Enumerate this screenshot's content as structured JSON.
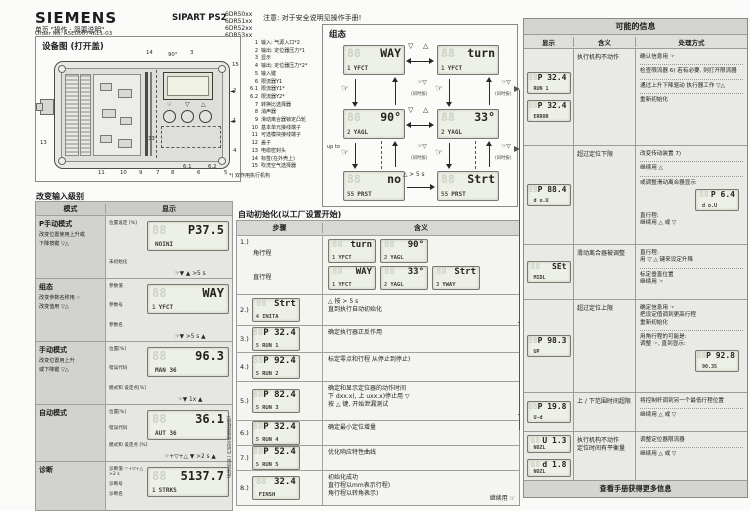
{
  "decor": {
    "lcd_ghost": "88"
  },
  "header": {
    "brand": "SIEMENS",
    "subtitle": "单页 \"操作 · 简要说明\"",
    "order_no": "Order No. A5E00074611-03",
    "product": "SIPART PS2",
    "models": [
      "6DR50xx",
      "6DR51xx",
      "6DR52xx",
      "6DR53xx"
    ],
    "note": "注意: 对于安全说明见操作手册!"
  },
  "device": {
    "title": "设备图 (打开盖)",
    "footnote": "*) 双作用执行机构",
    "keys": {
      "hand": "☞",
      "down": "▽",
      "up": "△"
    },
    "callouts": [
      "14",
      "90°",
      "3",
      "15",
      "2",
      "1",
      "4",
      "13",
      "11",
      "10",
      "9",
      "7",
      "8",
      "6.1",
      "6",
      "6.2",
      "5",
      "33°"
    ],
    "legend": [
      {
        "no": "1",
        "label": "输入: 气源入口*2"
      },
      {
        "no": "2",
        "label": "输出: 定位器压力*1"
      },
      {
        "no": "3",
        "label": "显示"
      },
      {
        "no": "4",
        "label": "输出: 定位器压力*2*"
      },
      {
        "no": "5",
        "label": "输入键"
      },
      {
        "no": "6",
        "label": "限流器Y1"
      },
      {
        "no": "6.1",
        "label": "限流器Y1*"
      },
      {
        "no": "6.2",
        "label": "限流器Y2*"
      },
      {
        "no": "7",
        "label": "转换比选择器"
      },
      {
        "no": "8",
        "label": "消声器"
      },
      {
        "no": "9",
        "label": "滑动离合器锁定凸轮"
      },
      {
        "no": "10",
        "label": "基本单元接线端子"
      },
      {
        "no": "11",
        "label": "可选模块接线端子"
      },
      {
        "no": "12",
        "label": "盖子"
      },
      {
        "no": "13",
        "label": "电缆密封头"
      },
      {
        "no": "14",
        "label": "标签(在外壳上)"
      },
      {
        "no": "15",
        "label": "吹洗空气选择器"
      }
    ]
  },
  "config_flow": {
    "title": "组态",
    "keys": {
      "hand": "☞",
      "down": "▽",
      "up": "△",
      "hand_down": "☞▽"
    },
    "labels": {
      "simul": "(同时按)",
      "upto": "up to",
      "hold": "△  > 5 s"
    },
    "lcds": {
      "way": {
        "v": "WAY",
        "n": "1",
        "l": "YFCT"
      },
      "turn": {
        "v": "turn",
        "n": "1",
        "l": "YFCT"
      },
      "a90": {
        "v": "90°",
        "n": "2",
        "l": "YAGL"
      },
      "a33": {
        "v": "33°",
        "n": "2",
        "l": "YAGL"
      },
      "no": {
        "v": "no",
        "n": "55",
        "l": "PRST"
      },
      "strt": {
        "v": "Strt",
        "n": "55",
        "l": "PRST"
      }
    }
  },
  "input_levels": {
    "title": "改变输入级别",
    "col_mode": "模式",
    "col_display": "显示",
    "gaps": [
      "☞▼  ▲  >5 s",
      "☞▼ >5 s ▲",
      "☞▼  1x  ▲",
      "☞+▽+△ ▼ >2 s ▲"
    ],
    "rows": [
      {
        "mode": "P手动模式",
        "desc": [
          "改变位置使用上升或",
          "下降按键 ▽△"
        ],
        "labels": [
          "位置设定 [%]",
          "未初始化"
        ],
        "lcd": {
          "v": "P37.5",
          "n": "",
          "l": "NOINI"
        }
      },
      {
        "mode": "组态",
        "desc": [
          "改变参数名称用 ☞",
          "改变值用 ▽△"
        ],
        "labels": [
          "参数值",
          "参数号",
          "参数名"
        ],
        "lcd": {
          "v": "WAY",
          "n": "1",
          "l": "YFCT"
        }
      },
      {
        "mode": "手动模式",
        "desc": [
          "改变位置用上升",
          "或下降键 ▽△"
        ],
        "labels": [
          "位置[%]",
          "错误代码",
          "模式和 设定点[%]"
        ],
        "lcd": {
          "v": "96.3",
          "n": "",
          "l": "MAN 36"
        }
      },
      {
        "mode": "自动模式",
        "desc": [],
        "labels": [
          "位置[%]",
          "错误代码",
          "模式和 设定点 [%]"
        ],
        "lcd": {
          "v": "36.1",
          "n": "",
          "l": "AUT 36"
        }
      },
      {
        "mode": "诊断",
        "desc": [],
        "labels": [
          "诊断值 ☞+▽+△ >2 s",
          "诊断号",
          "诊断名"
        ],
        "lcd": {
          "v": "5137.7",
          "n": "1",
          "l": "STRKS"
        }
      }
    ]
  },
  "auto_init": {
    "title": "自动初始化(以工厂设置开始)",
    "col_step": "步骤",
    "col_meaning": "含义",
    "side_note": "(在显示屏一行的灰色值是样例)",
    "rows": [
      {
        "step": "1.)",
        "type": "dual",
        "subs": [
          {
            "cap": "角行程",
            "lcds": [
              {
                "v": "turn",
                "n": "1",
                "l": "YFCT"
              },
              {
                "v": "90°",
                "n": "2",
                "l": "YAGL"
              }
            ]
          },
          {
            "cap": "直行程",
            "lcds": [
              {
                "v": "WAY",
                "n": "1",
                "l": "YFCT"
              },
              {
                "v": "33°",
                "n": "2",
                "l": "YAGL"
              },
              {
                "v": "Strt",
                "n": "3",
                "l": "YWAY"
              }
            ]
          }
        ]
      },
      {
        "step": "2.)",
        "lcd": {
          "v": "Strt",
          "n": "4",
          "l": "INITA"
        },
        "meaning": [
          "△ 按 > 5 s",
          "直到执行自动初始化"
        ]
      },
      {
        "step": "3.)",
        "lcd": {
          "v": "P 32.4",
          "n": "5",
          "l": "RUN 1"
        },
        "meaning": [
          "确定执行器正反作用"
        ]
      },
      {
        "step": "4.)",
        "lcd": {
          "v": "P 92.4",
          "n": "5",
          "l": "RUN 2"
        },
        "meaning": [
          "标定零点和行程 从停止到停止)"
        ]
      },
      {
        "step": "5.)",
        "lcd": {
          "v": "P 82.4",
          "n": "5",
          "l": "RUN 3"
        },
        "meaning": [
          "确定和显示定位器的动作时间",
          "下 dxx.x), 上 uxx.x)停止用 ▽",
          "按 △ 键, 开始泄漏测试"
        ]
      },
      {
        "step": "6.)",
        "lcd": {
          "v": "P 32.4",
          "n": "5",
          "l": "RUN 4"
        },
        "meaning": [
          "确定最小定位增量"
        ]
      },
      {
        "step": "7.)",
        "lcd": {
          "v": "P 52.4",
          "n": "5",
          "l": "RUN 5"
        },
        "meaning": [
          "优化响应特性曲线"
        ]
      },
      {
        "step": "8.)",
        "lcd": {
          "v": "32.4",
          "n": "",
          "l": "FINSH"
        },
        "meaning": [
          "初始化成功",
          "直行程以mm表示行程)",
          "角行程以转角表示)"
        ],
        "note": "继续用 ☞"
      }
    ]
  },
  "messages": {
    "title": "可能的信息",
    "cols": [
      "显示",
      "含义",
      "处理方式"
    ],
    "footer": "查看手册获得更多信息",
    "rows": [
      {
        "displays": [
          {
            "v": "P 32.4",
            "n": "",
            "l": "RUN 1"
          },
          {
            "v": "P 32.4",
            "n": "",
            "l": "ERROR"
          }
        ],
        "meaning": [
          "执行机构不动作"
        ],
        "action": [
          [
            "确认信息用 ☞"
          ],
          [
            "检查限流器 6) 若有必要, 则打开限流器"
          ],
          [
            "通过上升下降驱动 执行器工作 ▽△"
          ],
          [
            "重新初始化"
          ]
        ]
      },
      {
        "displays": [
          {
            "v": "P 88.4",
            "n": "",
            "l": "d o.U"
          }
        ],
        "meaning": [
          "超过定位下限"
        ],
        "action": [
          [
            "改变传动装置 7)"
          ],
          [
            "继续用 △"
          ],
          [
            "或调整滑动离合器显示",
            {
              "lcd": {
                "v": "P 6.4",
                "n": "",
                "l": "d o.U"
              }
            },
            "直行程:",
            "继续用 △ 或 ▽"
          ]
        ]
      },
      {
        "displays": [
          {
            "v": "SEt",
            "n": "",
            "l": "MIDL"
          }
        ],
        "meaning": [
          "滑动离合器被调整"
        ],
        "action": [
          [
            "直行程:",
            "用 ▽ △ 键来设定升降"
          ],
          [
            "标定垂直位置",
            "继续用 ☞"
          ]
        ]
      },
      {
        "displays": [
          {
            "v": "P 98.3",
            "n": "",
            "l": "UP"
          }
        ],
        "meaning": [
          "超过定位上限"
        ],
        "action": [
          [
            "确定信息用 ☞",
            "把设定值调到更高行程",
            "重新初始化"
          ],
          [
            "用角行程的可能是:",
            "调整 ☞, 直到显示:",
            {
              "lcd": {
                "v": "P 92.8",
                "n": "",
                "l": "90.35"
              }
            }
          ]
        ]
      },
      {
        "displays": [
          {
            "v": "P 19.8",
            "n": "",
            "l": "U-d"
          }
        ],
        "meaning": [
          "上 / 下范围时间超限"
        ],
        "action": [
          [
            "将控制杆调到另一个最低行程位置"
          ],
          [
            "继续用 △ 或 ▽"
          ]
        ]
      },
      {
        "displays": [
          {
            "v": "U 1.3",
            "n": "",
            "l": "NOZL"
          },
          {
            "v": "d 1.8",
            "n": "",
            "l": "NOZL"
          }
        ],
        "meaning": [
          "执行机构不动作",
          "定位时间有平衡量"
        ],
        "action": [
          [
            "调整定位器限流器"
          ],
          [
            "继续用 △ 或 ▽"
          ]
        ]
      }
    ]
  }
}
